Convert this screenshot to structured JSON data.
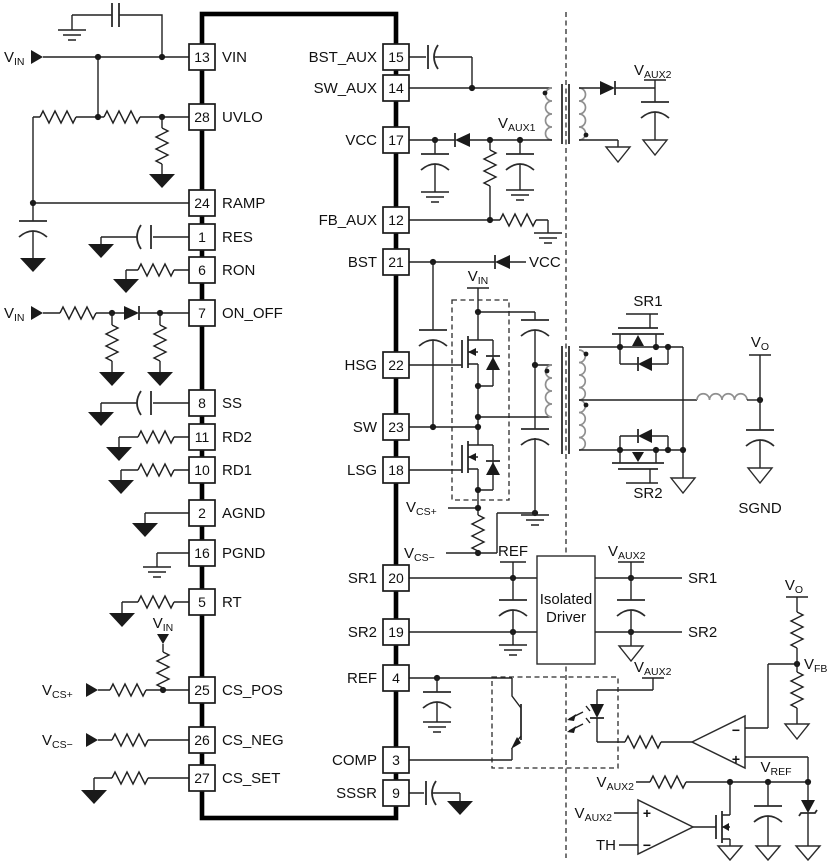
{
  "ic": {
    "left_pins": [
      {
        "num": "13",
        "label": "VIN"
      },
      {
        "num": "28",
        "label": "UVLO"
      },
      {
        "num": "24",
        "label": "RAMP"
      },
      {
        "num": "1",
        "label": "RES"
      },
      {
        "num": "6",
        "label": "RON"
      },
      {
        "num": "7",
        "label": "ON_OFF"
      },
      {
        "num": "8",
        "label": "SS"
      },
      {
        "num": "11",
        "label": "RD2"
      },
      {
        "num": "10",
        "label": "RD1"
      },
      {
        "num": "2",
        "label": "AGND"
      },
      {
        "num": "16",
        "label": "PGND"
      },
      {
        "num": "5",
        "label": "RT"
      },
      {
        "num": "25",
        "label": "CS_POS"
      },
      {
        "num": "26",
        "label": "CS_NEG"
      },
      {
        "num": "27",
        "label": "CS_SET"
      }
    ],
    "right_pins": [
      {
        "num": "15",
        "label": "BST_AUX"
      },
      {
        "num": "14",
        "label": "SW_AUX"
      },
      {
        "num": "17",
        "label": "VCC"
      },
      {
        "num": "12",
        "label": "FB_AUX"
      },
      {
        "num": "21",
        "label": "BST"
      },
      {
        "num": "22",
        "label": "HSG"
      },
      {
        "num": "23",
        "label": "SW"
      },
      {
        "num": "18",
        "label": "LSG"
      },
      {
        "num": "20",
        "label": "SR1"
      },
      {
        "num": "19",
        "label": "SR2"
      },
      {
        "num": "4",
        "label": "REF"
      },
      {
        "num": "3",
        "label": "COMP"
      },
      {
        "num": "9",
        "label": "SSSR"
      }
    ]
  },
  "labels": {
    "vin": {
      "base": "V",
      "sub": "IN"
    },
    "vaux1": {
      "base": "V",
      "sub": "AUX1"
    },
    "vaux2": {
      "base": "V",
      "sub": "AUX2"
    },
    "vcs_plus": {
      "base": "V",
      "sub": "CS+"
    },
    "vcs_minus": {
      "base": "V",
      "sub": "CS−"
    },
    "vo": {
      "base": "V",
      "sub": "O"
    },
    "vfb": {
      "base": "V",
      "sub": "FB"
    },
    "vref": {
      "base": "V",
      "sub": "REF"
    },
    "vcc": "VCC",
    "ref": "REF",
    "th": "TH",
    "sr1": "SR1",
    "sr2": "SR2",
    "sgnd": "SGND",
    "isolated_driver": {
      "line1": "Isolated",
      "line2": "Driver"
    },
    "plus": "+",
    "minus": "−"
  },
  "colors": {
    "line": "#212121",
    "coil_gray": "#8f8f8f",
    "background": "#ffffff"
  }
}
